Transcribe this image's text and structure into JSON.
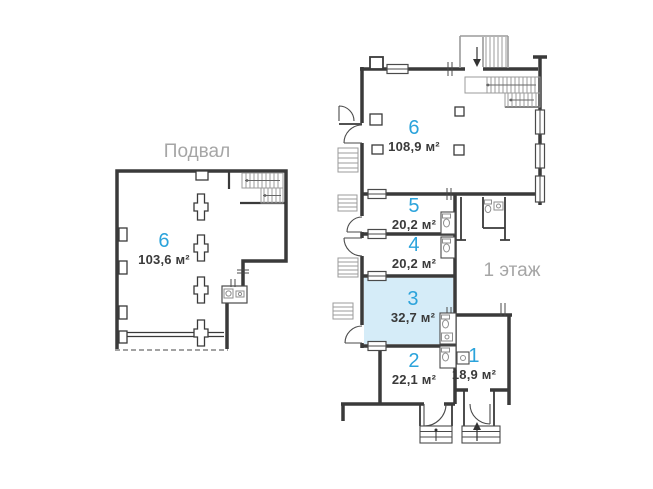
{
  "canvas": {
    "width": 653,
    "height": 489,
    "background": "#ffffff"
  },
  "colors": {
    "wall_dark": "#3a3a3a",
    "wall_light": "#9b9b9b",
    "accent_blue": "#2ba3db",
    "highlight_fill": "#d5ecf8",
    "title_gray": "#a6a6a6",
    "area_text": "#3a3a3a"
  },
  "plans": {
    "basement": {
      "title": "Подвал",
      "rooms": [
        {
          "number": "6",
          "area": "103,6 м²",
          "highlighted": false
        }
      ]
    },
    "first_floor": {
      "title": "1 этаж",
      "rooms": [
        {
          "number": "6",
          "area": "108,9 м²",
          "highlighted": false
        },
        {
          "number": "5",
          "area": "20,2 м²",
          "highlighted": false
        },
        {
          "number": "4",
          "area": "20,2 м²",
          "highlighted": false
        },
        {
          "number": "3",
          "area": "32,7 м²",
          "highlighted": true
        },
        {
          "number": "2",
          "area": "22,1 м²",
          "highlighted": false
        },
        {
          "number": "1",
          "area": "18,9 м²",
          "highlighted": false
        }
      ]
    }
  }
}
